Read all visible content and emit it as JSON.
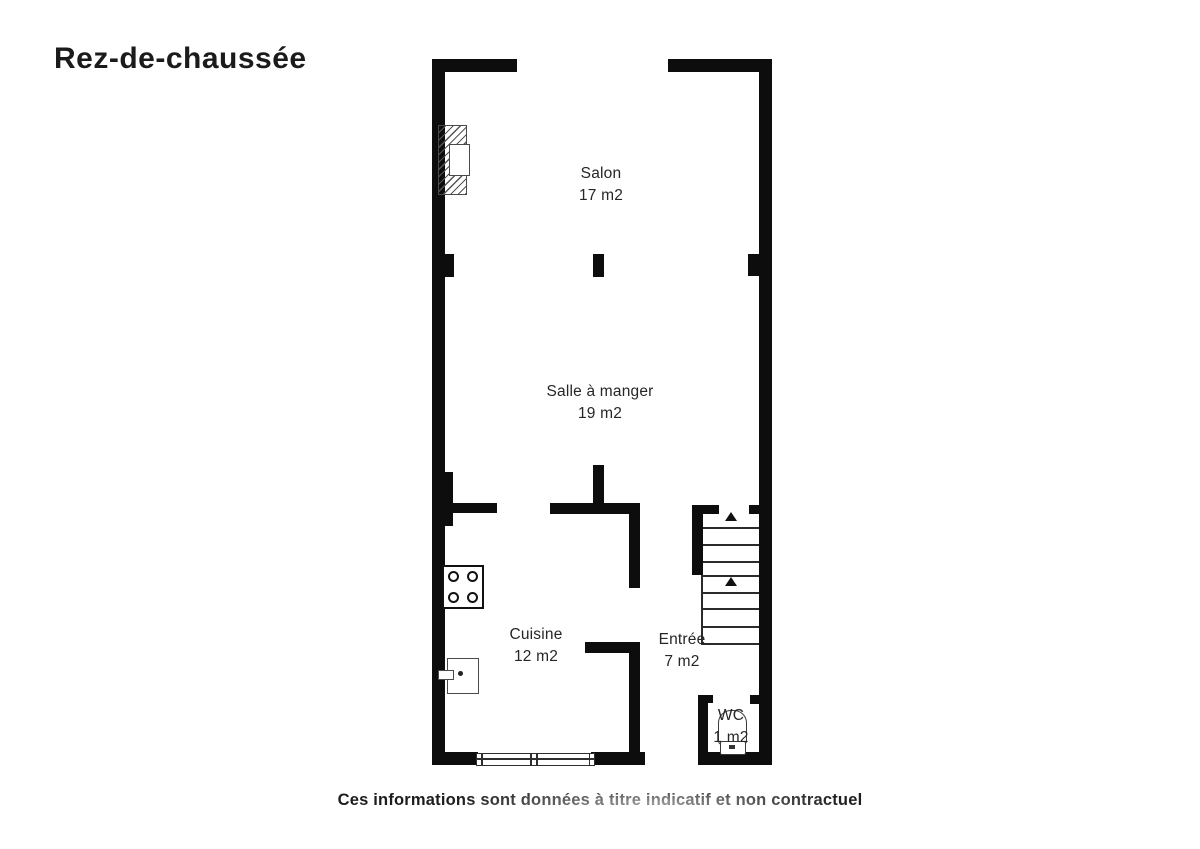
{
  "title": "Rez-de-chaussée",
  "rooms": [
    {
      "name": "Salon",
      "area": "17 m2"
    },
    {
      "name": "Salle à manger",
      "area": "19 m2"
    },
    {
      "name": "Cuisine",
      "area": "12 m2"
    },
    {
      "name": "Entrée",
      "area": "7 m2"
    },
    {
      "name": "WC",
      "area": "1 m2"
    }
  ],
  "disclaimer": "Ces informations sont données à titre indicatif et non contractuel",
  "symbols": {
    "fireplace": "hatched chimney with firebox",
    "stove": "four-burner hob",
    "appliance": "water heater with handle and dot",
    "stairs": "two flights with up arrows",
    "toilet": "wc toilet bowl and tank",
    "window": "double casement window in bottom wall"
  },
  "colors": {
    "wall": "#0d0d0d",
    "text": "#262626",
    "stroke": "#3a3a3a",
    "background": "#ffffff"
  }
}
